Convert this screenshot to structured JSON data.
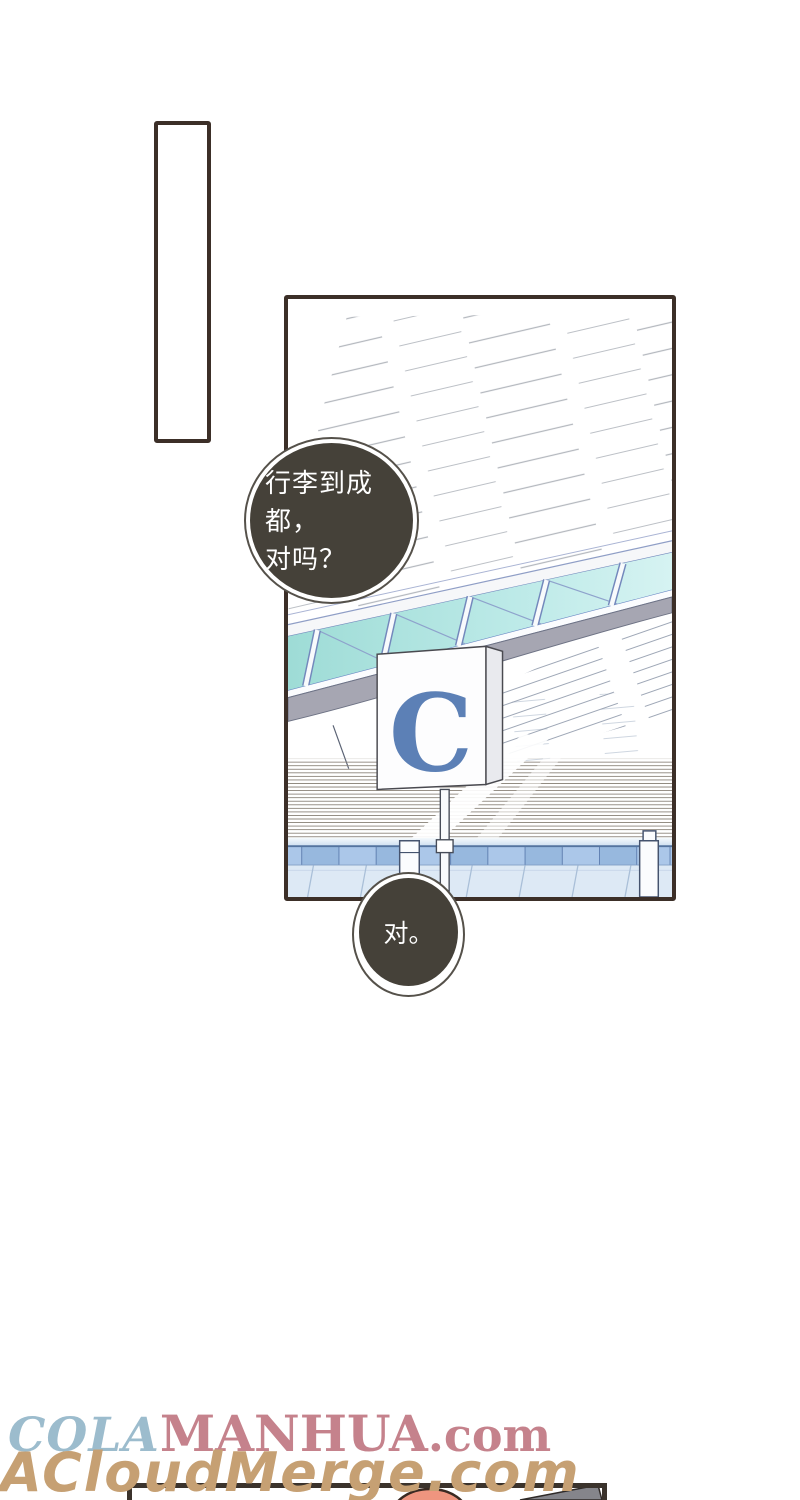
{
  "bubbles": {
    "first": {
      "line1": "行李到成都，",
      "line2": "对吗？"
    },
    "second": {
      "text": "对。"
    }
  },
  "sign": {
    "letter": "C"
  },
  "watermarks": {
    "cola": "COLA",
    "manhua": "MANHUA",
    "com_suffix": ".com",
    "second_line": "ACloudMerge.com"
  },
  "colors": {
    "panel_border": "#3c2f28",
    "bubble_fill": "#454139",
    "bubble_text": "#ffffff",
    "sign_letter": "#5c80b6",
    "glass_teal": "#9edcd6",
    "truss_gray": "#a6a6b2",
    "railing_blue": "#abc7e9",
    "lower_wall_blue": "#dde9f5",
    "watermark_cola": "#9cbccd",
    "watermark_manhua": "#c5828c",
    "watermark_bottom": "#c6a073",
    "hair_salmon": "#ef957f"
  }
}
